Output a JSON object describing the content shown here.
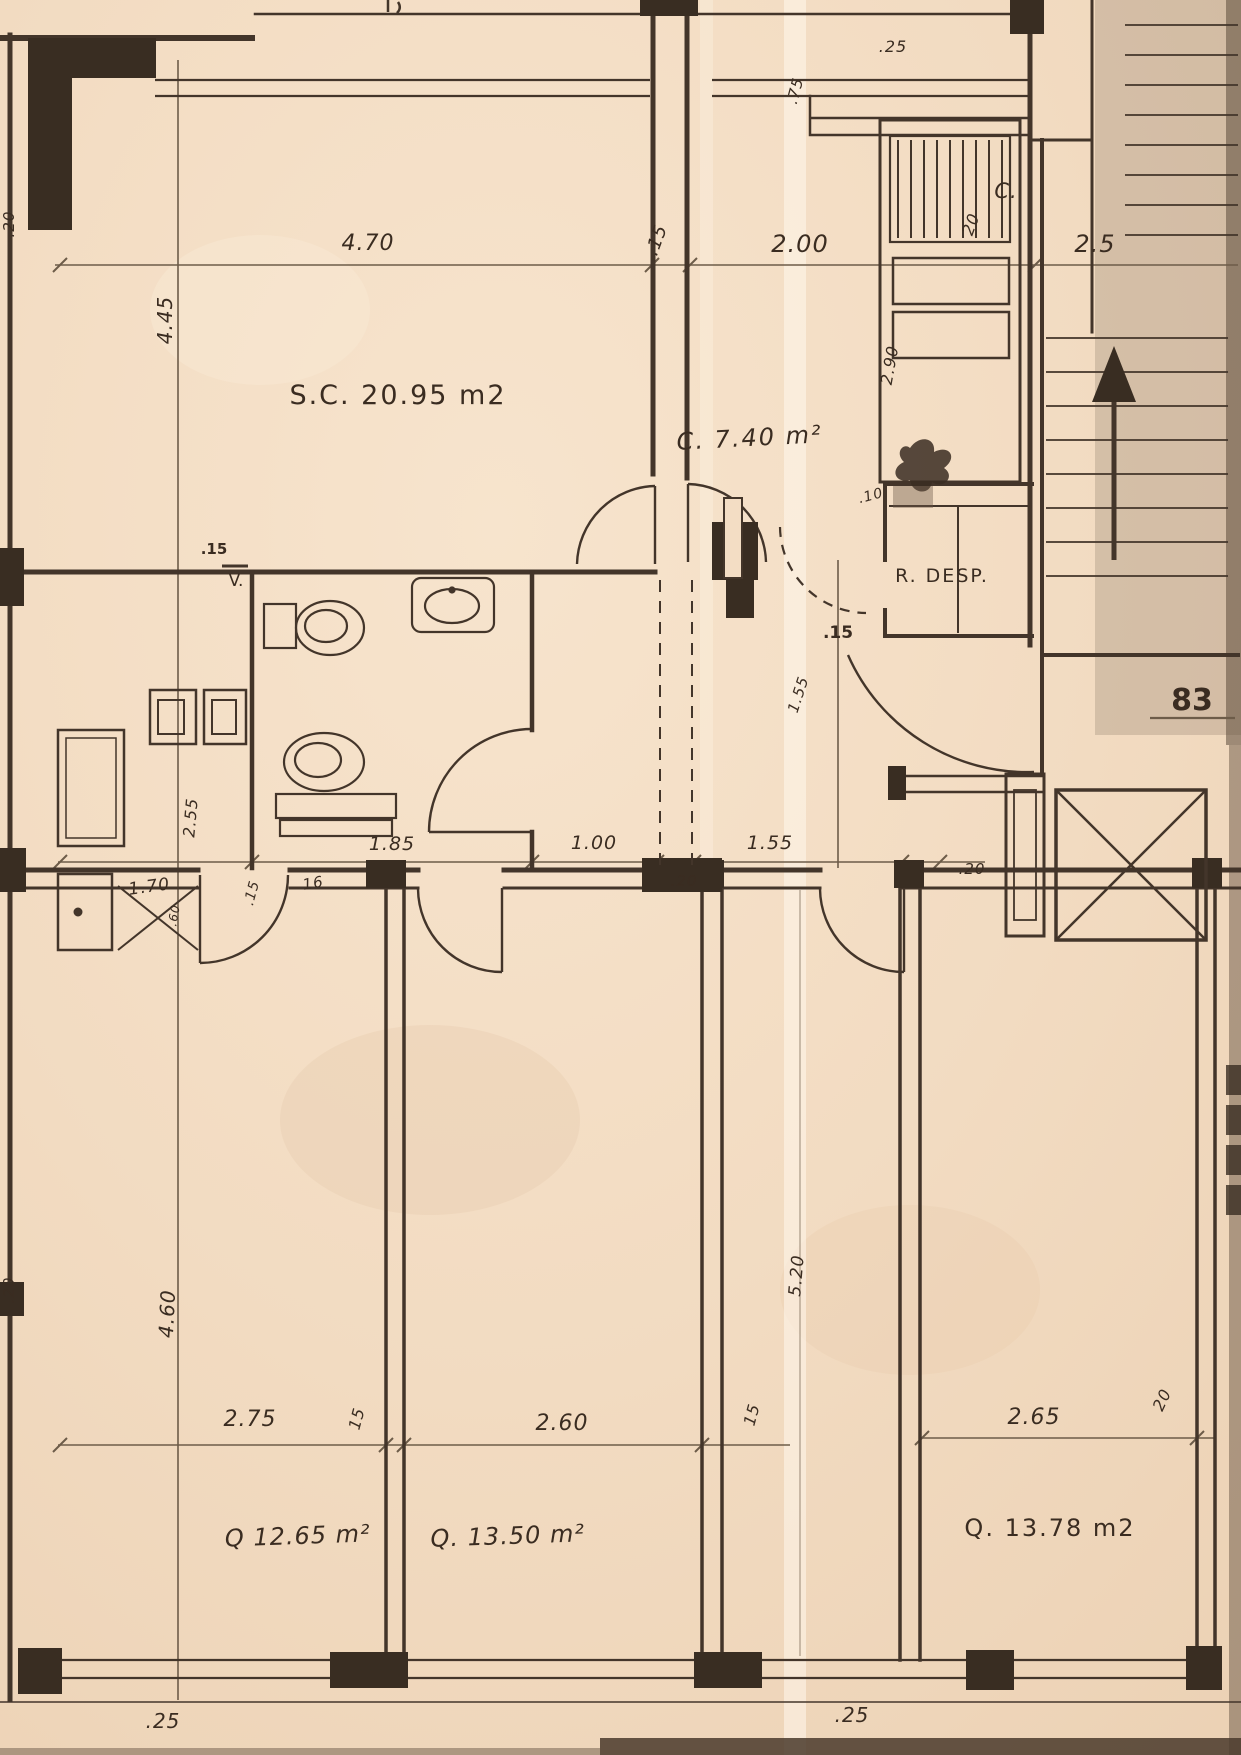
{
  "colors": {
    "paper": "#f3ddc4",
    "ink": "#43352a"
  },
  "rooms": {
    "living": "S.C. 20.95 m2",
    "kitchen": "C. 7.40 m²",
    "pantry": "R. DESP.",
    "closet": "C.",
    "bedroom1": "Q 12.65 m²",
    "bedroom2": "Q. 13.50 m²",
    "bedroom3": "Q. 13.78 m2"
  },
  "annotations": {
    "stair_number": "83",
    "vent": "V."
  },
  "dims": {
    "top": {
      "w_living": "4.70",
      "wall_15": ".15",
      "w_kitchen": "2.00",
      "d25": ".25",
      "d75": ".75",
      "d20": "20",
      "right": "2.5"
    },
    "left": {
      "h_living": "4.45",
      "d20_top": ".20",
      "h_bath": "2.55",
      "d20_bottom": ".20",
      "h_bed": "4.60"
    },
    "mid": {
      "bath": "1.85",
      "hall": "1.00",
      "foyer": "1.55",
      "d20_a": ".20",
      "d20_b": ".20",
      "w16": "16",
      "laundry": "1.70",
      "d15": ".15",
      "d15_pier": ".15",
      "d15_v": ".15",
      "kitchen_h": "2.90",
      "d10": ".10",
      "foyer_rot": "1.55",
      "d60": ".60"
    },
    "bottom": {
      "bed1": "2.75",
      "wall1": "15",
      "bed2": "2.60",
      "wall2": "15",
      "bed3": "2.65",
      "wall3": "20",
      "hall_h": "5.20",
      "d25_left": ".25",
      "d25_right": ".25"
    }
  }
}
